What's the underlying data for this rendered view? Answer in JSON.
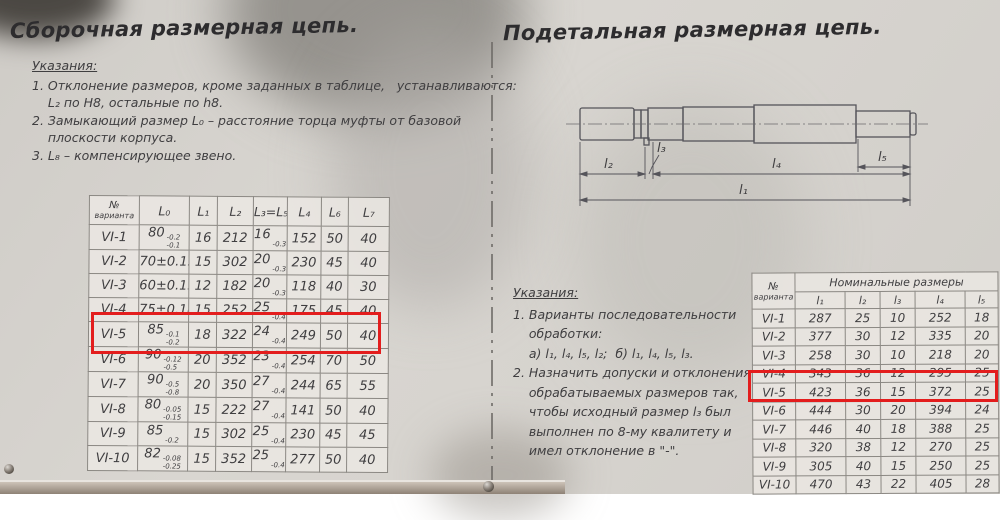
{
  "colors": {
    "paper": "#d7d4cf",
    "ink": "#3f3e40",
    "highlight": "#e31d1d"
  },
  "left_page": {
    "title": "Сборочная размерная цепь.",
    "notes": {
      "heading": "Указания:",
      "lines": [
        "1. Отклонение размеров, кроме заданных в таблице,   устанавливаются:",
        "    L₂ по H8, остальные по h8.",
        "2. Замыкающий размер L₀ – расстояние торца муфты от базовой",
        "    плоскости корпуса.",
        "3. L₈ – компенсирующее звено."
      ]
    },
    "table": {
      "variant_header": {
        "line1": "№",
        "line2": "варианта"
      },
      "col_headers": [
        "L₀",
        "L₁",
        "L₂",
        "L₃=L₅",
        "L₄",
        "L₆",
        "L₇"
      ],
      "rows": [
        [
          "VI-1",
          [
            "80",
            "-0.2",
            "-0.1"
          ],
          "16",
          "212",
          [
            "16",
            "",
            "-0.3"
          ],
          "152",
          "50",
          "40"
        ],
        [
          "VI-2",
          "70±0.15",
          "15",
          "302",
          [
            "20",
            "",
            "-0.3"
          ],
          "230",
          "45",
          "40"
        ],
        [
          "VI-3",
          "60±0.15",
          "12",
          "182",
          [
            "20",
            "",
            "-0.3"
          ],
          "118",
          "40",
          "30"
        ],
        [
          "VI-4",
          "75±0.18",
          "15",
          "252",
          [
            "25",
            "",
            "-0.4"
          ],
          "175",
          "45",
          "40"
        ],
        [
          "VI-5",
          [
            "85",
            "-0.1",
            "-0.2"
          ],
          "18",
          "322",
          [
            "24",
            "",
            "-0.4"
          ],
          "249",
          "50",
          "40"
        ],
        [
          "VI-6",
          [
            "90",
            "-0.12",
            "-0.5"
          ],
          "20",
          "352",
          [
            "23",
            "",
            "-0.4"
          ],
          "254",
          "70",
          "50"
        ],
        [
          "VI-7",
          [
            "90",
            "-0.5",
            "-0.8"
          ],
          "20",
          "350",
          [
            "27",
            "",
            "-0.4"
          ],
          "244",
          "65",
          "55"
        ],
        [
          "VI-8",
          [
            "80",
            "-0.05",
            "-0.15"
          ],
          "15",
          "222",
          [
            "27",
            "",
            "-0.4"
          ],
          "141",
          "50",
          "40"
        ],
        [
          "VI-9",
          [
            "85",
            "",
            "-0.2"
          ],
          "15",
          "302",
          [
            "25",
            "",
            "-0.4"
          ],
          "230",
          "45",
          "45"
        ],
        [
          "VI-10",
          [
            "82",
            "-0.08",
            "-0.25"
          ],
          "15",
          "352",
          [
            "25",
            "",
            "-0.4"
          ],
          "277",
          "50",
          "40"
        ]
      ],
      "highlighted_variant": "VI-5"
    }
  },
  "right_page": {
    "title": "Подетальная размерная цепь.",
    "drawing": {
      "labels": [
        "l₂",
        "l₃",
        "l₄",
        "l₅",
        "l₁"
      ]
    },
    "notes": {
      "heading": "Указания:",
      "lines": [
        "1. Варианты последовательности",
        "    обработки:",
        "    а) l₁, l₄, l₅, l₂;  б) l₁, l₄, l₅, l₃.",
        "2. Назначить допуски и отклонения",
        "    обрабатываемых размеров так,",
        "    чтобы исходный размер l₃ был",
        "    выполнен по 8-му квалитету и",
        "    имел отклонение в \"-\"."
      ]
    },
    "table": {
      "variant_header": {
        "line1": "№",
        "line2": "варианта"
      },
      "group_header": "Номинальные размеры",
      "col_headers": [
        "l₁",
        "l₂",
        "l₃",
        "l₄",
        "l₅"
      ],
      "rows": [
        [
          "VI-1",
          "287",
          "25",
          "10",
          "252",
          "18"
        ],
        [
          "VI-2",
          "377",
          "30",
          "12",
          "335",
          "20"
        ],
        [
          "VI-3",
          "258",
          "30",
          "10",
          "218",
          "20"
        ],
        [
          "VI-4",
          "343",
          "36",
          "12",
          "295",
          "25"
        ],
        [
          "VI-5",
          "423",
          "36",
          "15",
          "372",
          "25"
        ],
        [
          "VI-6",
          "444",
          "30",
          "20",
          "394",
          "24"
        ],
        [
          "VI-7",
          "446",
          "40",
          "18",
          "388",
          "25"
        ],
        [
          "VI-8",
          "320",
          "38",
          "12",
          "270",
          "25"
        ],
        [
          "VI-9",
          "305",
          "40",
          "15",
          "250",
          "25"
        ],
        [
          "VI-10",
          "470",
          "43",
          "22",
          "405",
          "28"
        ]
      ],
      "highlighted_variants": "VI-5, VI-6"
    }
  }
}
